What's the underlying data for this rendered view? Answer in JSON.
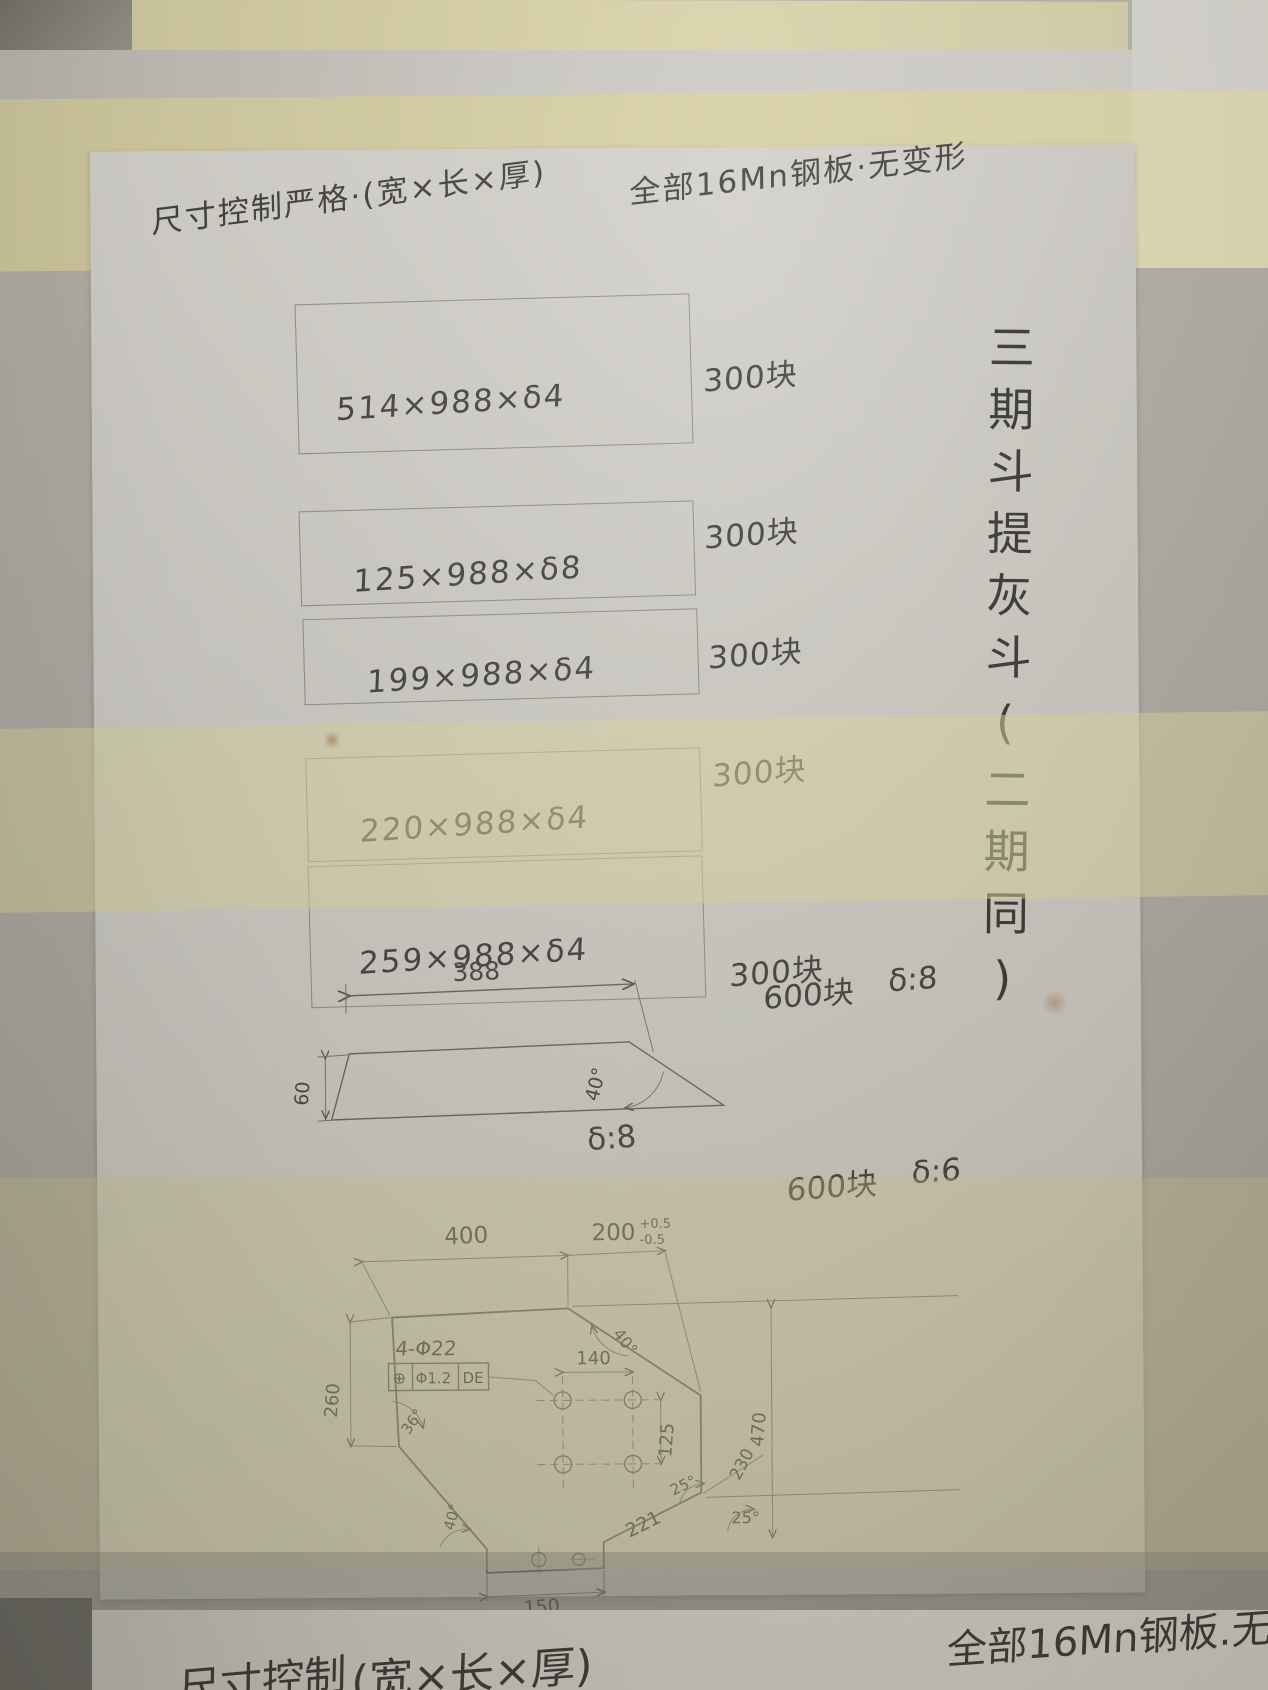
{
  "photo": {
    "title_left": "尺寸控制严格·(宽×长×厚)",
    "title_right": "全部16Mn钢板·无变形",
    "side_note_vertical": "三期斗提灰斗(二期同)",
    "plates": [
      {
        "size": "514×988×δ4",
        "count": "300块"
      },
      {
        "size": "125×988×δ8",
        "count": "300块"
      },
      {
        "size": "199×988×δ4",
        "count": "300块"
      },
      {
        "size": "220×988×δ4",
        "count": "300块"
      },
      {
        "size": "259×988×δ4",
        "count": "300块"
      }
    ],
    "trapezoid": {
      "top_dim": "388",
      "left_dim": "60",
      "angle": "40°",
      "thickness_label": "δ:8",
      "count": "600块",
      "count_thickness": "δ:8"
    },
    "plate_drawing": {
      "count": "600块",
      "count_thickness": "δ:6",
      "dim_400": "400",
      "dim_200": "200",
      "tol_plus": "+0.5",
      "tol_minus": "-0.5",
      "angle_chamfer": "40°",
      "holes_label": "4-Φ22",
      "gdt_symbol": "⊕",
      "gdt_tol": "Φ1.2",
      "gdt_datum": "DE",
      "dim_140": "140",
      "dim_125": "125",
      "dim_260": "260",
      "angle_left_top": "36°",
      "angle_left_bottom": "40°",
      "dim_470": "470",
      "dim_230": "230",
      "angle_25_a": "25°",
      "angle_25_b": "25°",
      "dim_221": "221",
      "dim_150": "150"
    },
    "next_sheet": {
      "fragment_left": "尺寸控制",
      "fragment_mid": "(宽×长×厚)",
      "fragment_right": "全部16Mn钢板.无变形"
    }
  }
}
